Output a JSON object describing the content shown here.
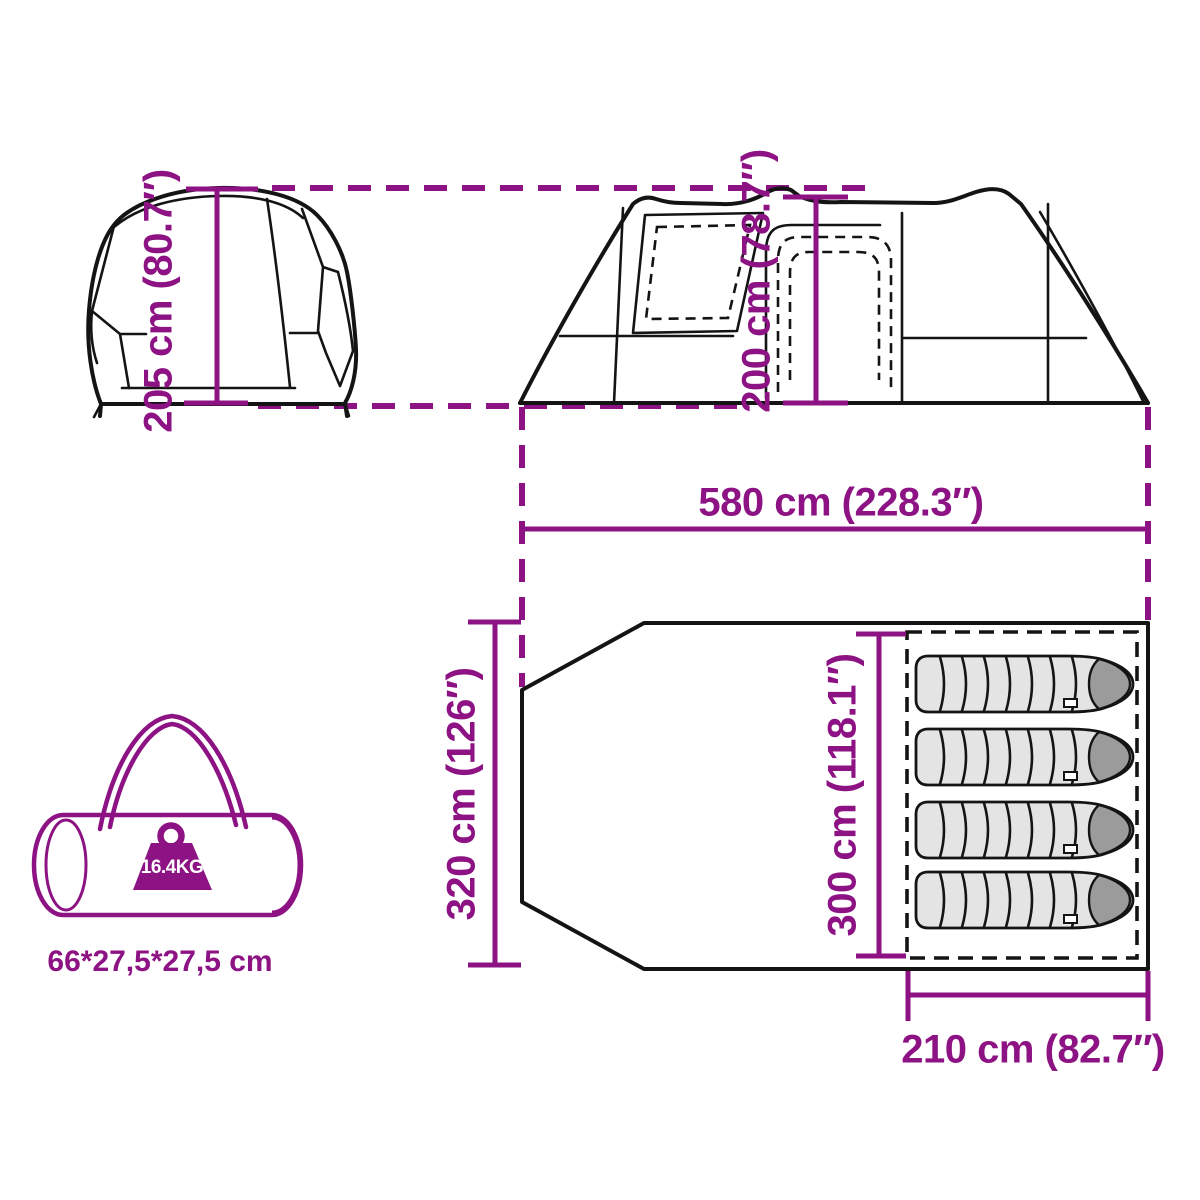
{
  "diagram": {
    "accent_color": "#8d1283",
    "front_view": {
      "height_label": "205 cm (80.7″)"
    },
    "side_view": {
      "height_label": "200 cm (78.7″)",
      "length_label": "580 cm (228.3″)"
    },
    "floor_plan": {
      "width_label": "320 cm (126″)",
      "sleeping_width_label": "300 cm (118.1″)",
      "sleeping_length_label": "210 cm (82.7″)",
      "sleeping_bag_count": 4
    },
    "carry_bag": {
      "weight_label": "16.4KG",
      "size_label": "66*27,5*27,5 cm"
    }
  }
}
